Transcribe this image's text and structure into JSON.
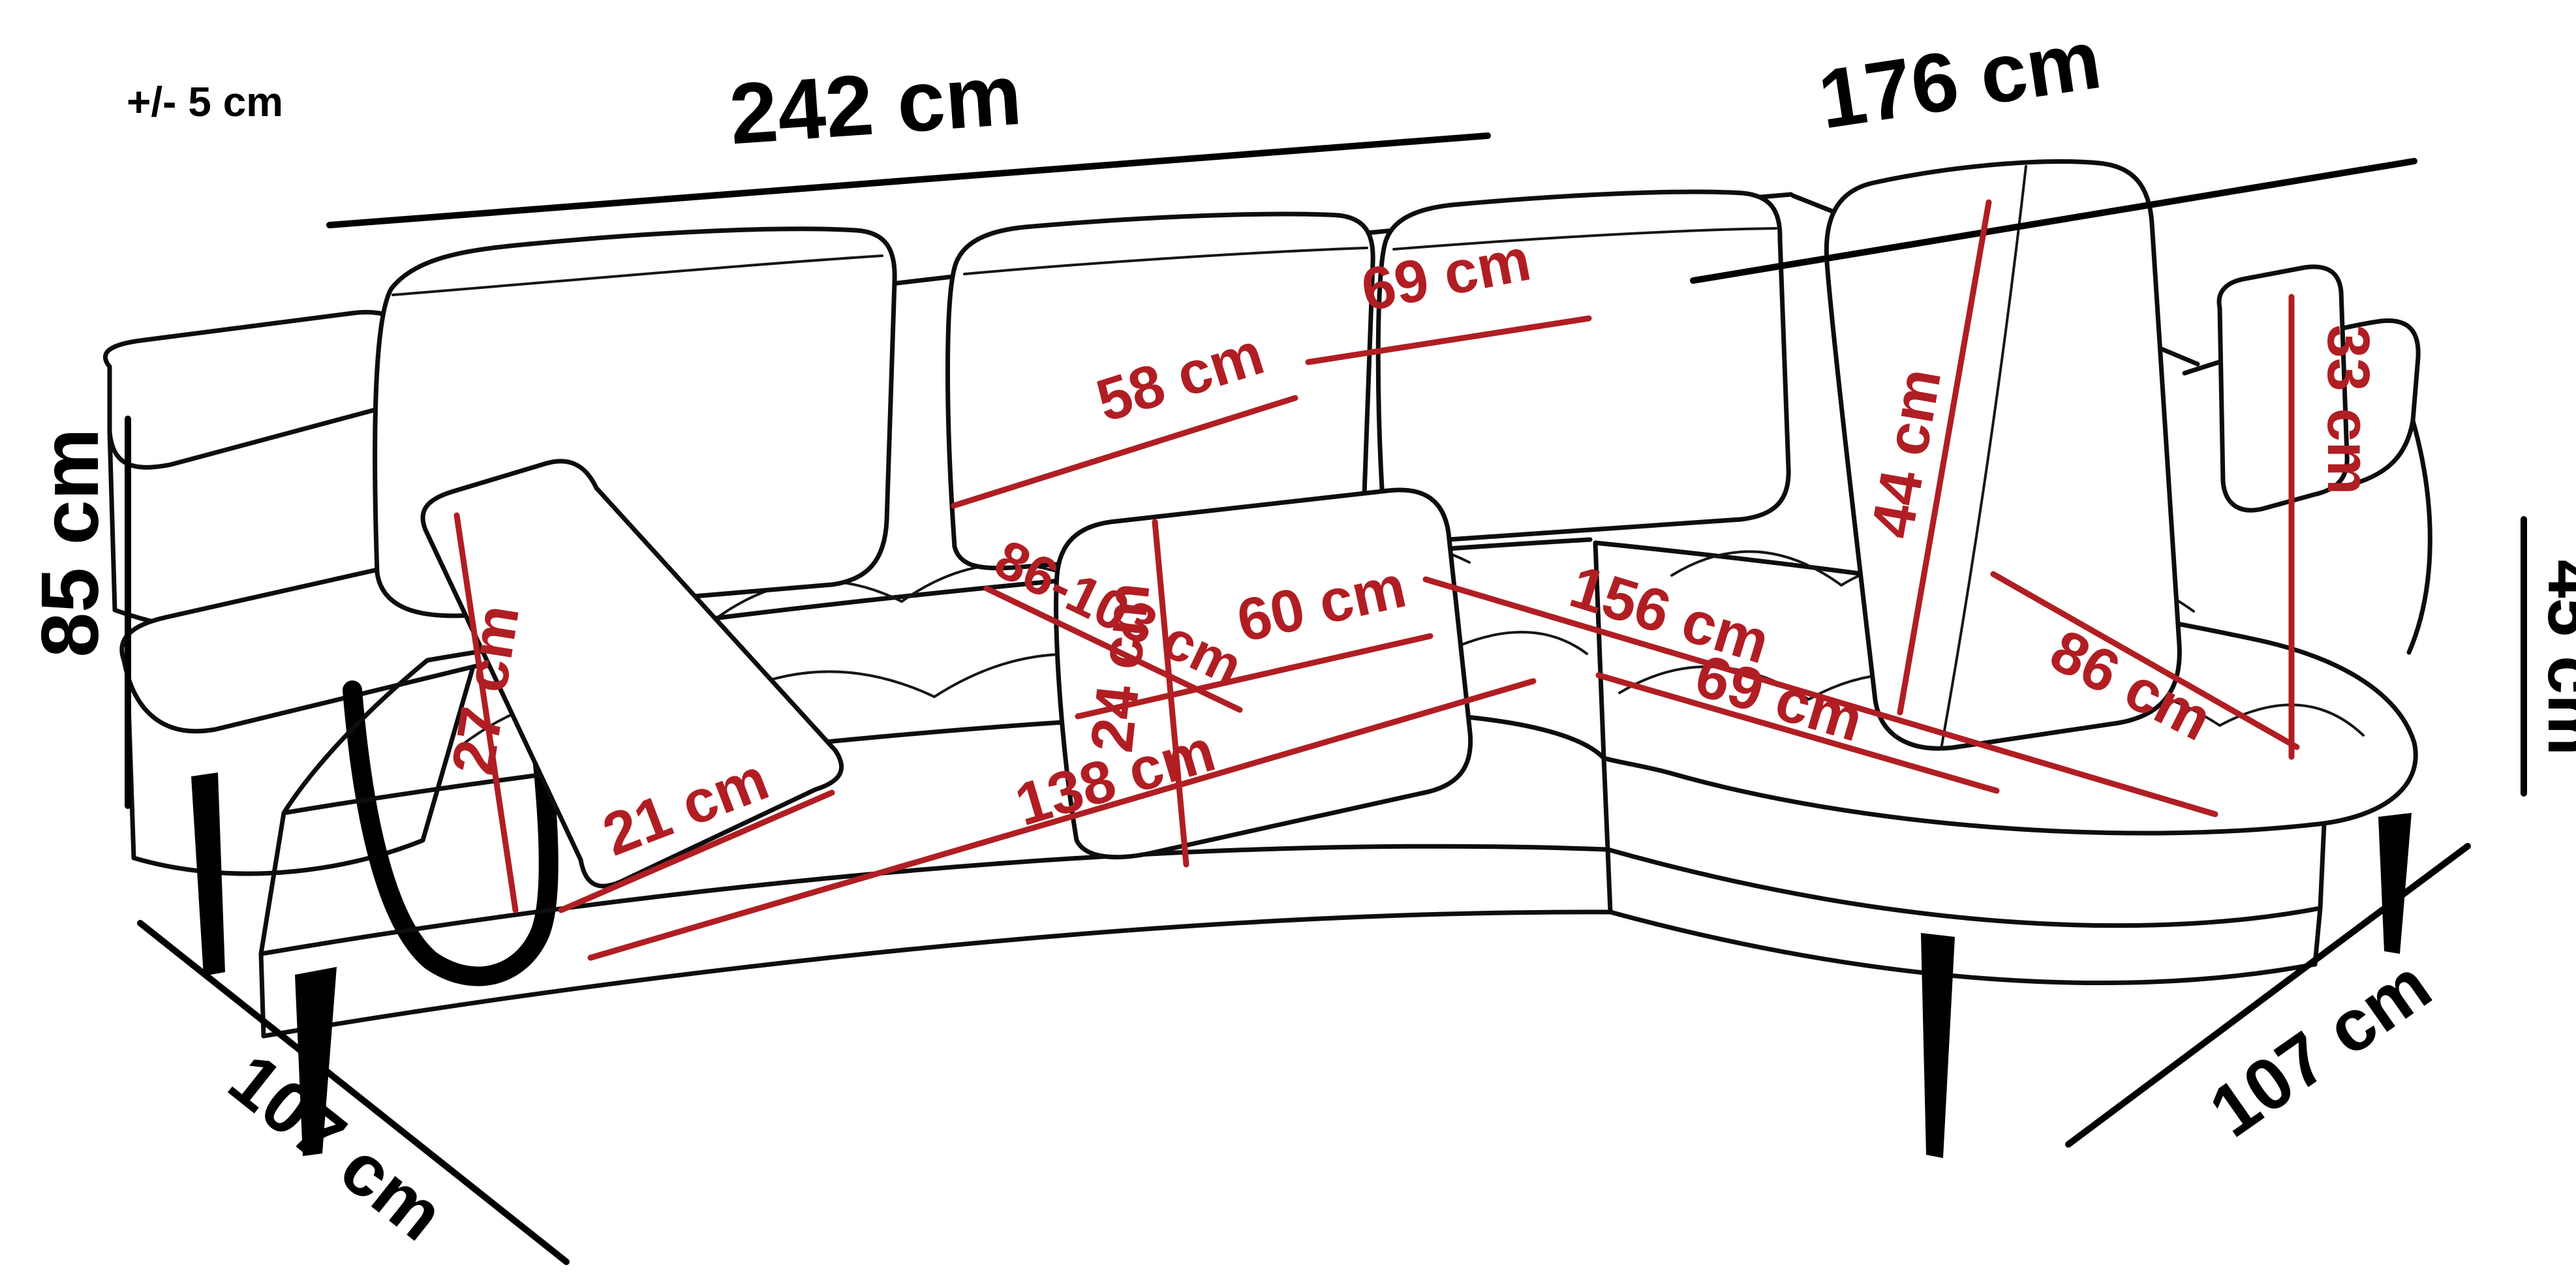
{
  "diagram": {
    "type": "corner-sofa dimension drawing",
    "unit": "cm",
    "background": "#ffffff",
    "outline_color": "#0d0d0d",
    "dimension_black_color": "#000000",
    "dimension_red_color": "#b01e23",
    "tolerance_note": "+/- 5 cm",
    "labels": {
      "total_width_left": "242 cm",
      "total_width_right": "176 cm",
      "total_height": "85 cm",
      "depth_bottom_left": "107 cm",
      "depth_bottom_right": "107 cm",
      "seat_height_right": "45 cm",
      "back_cushion_mid_width": "58 cm",
      "back_cushion_right_width": "69 cm",
      "back_cushion_large_height": "44 cm",
      "headrest_panel_height": "33 cm",
      "armrest_height": "27 cm",
      "armrest_width": "21 cm",
      "lumbar_pillow_height": "24 cm",
      "lumbar_pillow_width": "60 cm",
      "seat_depth_range": "86-103 cm",
      "chaise_length": "156 cm",
      "chaise_seat_width": "86 cm",
      "chaise_front_width": "69 cm",
      "seat_front_width": "138 cm"
    }
  }
}
